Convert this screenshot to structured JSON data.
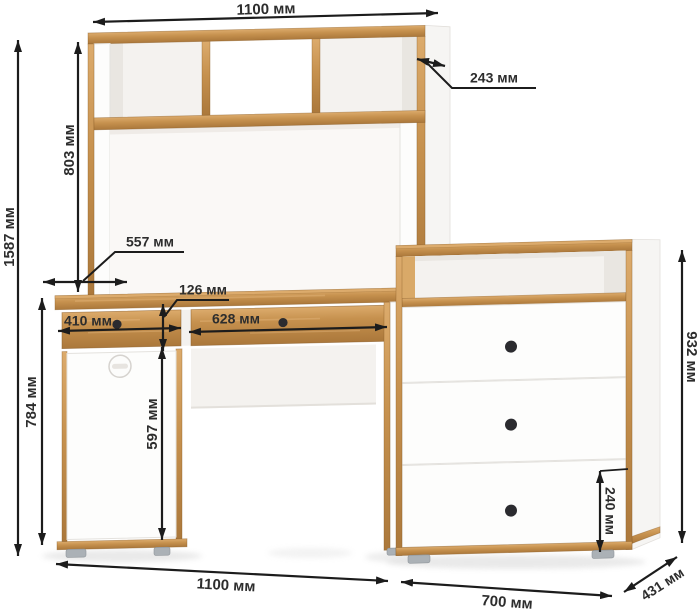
{
  "unit": "мм",
  "dims": {
    "hutch_top_width": "1100 мм",
    "hutch_depth": "243 мм",
    "hutch_height": "803 мм",
    "total_height": "1587 мм",
    "desktop_depth": "557 мм",
    "drawer_front_height": "126 мм",
    "left_drawer_width": "410 мм",
    "right_drawer_width": "628 мм",
    "desk_height": "784 мм",
    "door_height": "597 мм",
    "chest_height": "932 мм",
    "chest_bottom_drawer_height": "240 мм",
    "desk_width": "1100 мм",
    "chest_width": "700 мм",
    "chest_depth": "431 мм"
  },
  "colors": {
    "wood": "#c6914e",
    "woodLight": "#dcab6c",
    "woodDark": "#ab783b",
    "woodEdge": "#8a5c26",
    "white": "#fdfdfc",
    "knob": "#2b2b2f",
    "foot": "#abb1b6",
    "dim": "#1c1c1c",
    "labelText": "#2d2d2d",
    "bg": "#ffffff"
  }
}
